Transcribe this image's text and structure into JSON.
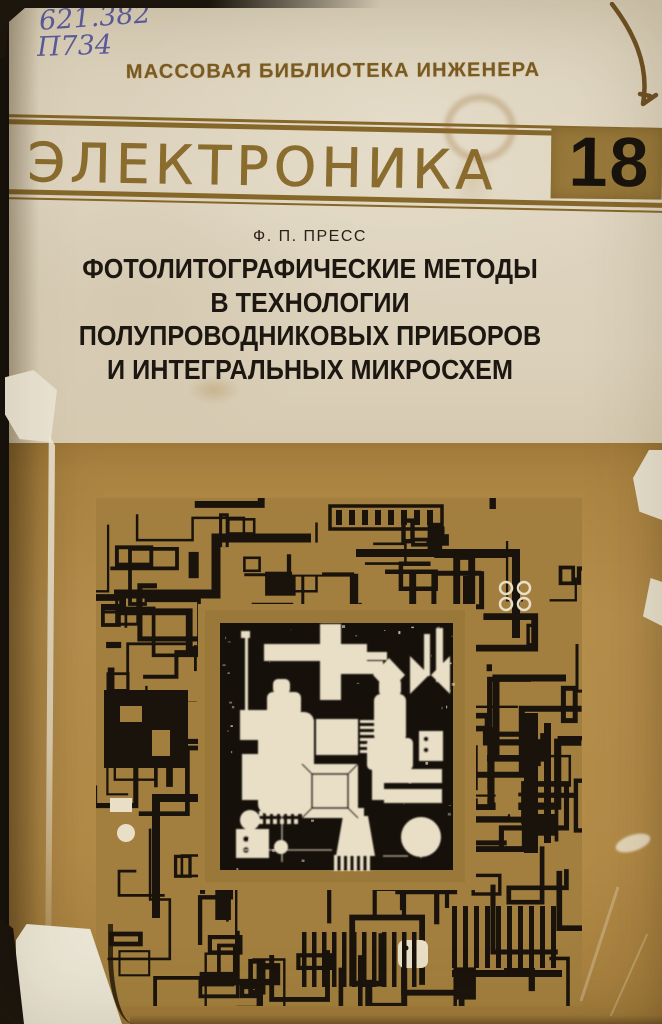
{
  "cover": {
    "call_number": {
      "line1": "621.382",
      "line2": "П734"
    },
    "series": {
      "label": "МАССОВАЯ БИБЛИОТЕКА ИНЖЕНЕРА",
      "name": "ЭЛЕКТРОНИКА",
      "number": "18"
    },
    "author": "Ф. П. ПРЕСС",
    "title_lines": [
      "ФОТОЛИТОГРАФИЧЕСКИЕ МЕТОДЫ",
      "В ТЕХНОЛОГИИ",
      "ПОЛУПРОВОДНИКОВЫХ ПРИБОРОВ",
      "И ИНТЕГРАЛЬНЫХ МИКРОСХЕМ"
    ],
    "colors": {
      "cream_paper": "#dcd1bb",
      "tan_panel": "#b0894a",
      "olive_accent": "#87682c",
      "gold_box": "#97783a",
      "print_black": "#1b1510",
      "ink_blue": "#4e4e9c",
      "art_cream": "#e9dec6",
      "art_tan": "#a27f3e"
    }
  }
}
